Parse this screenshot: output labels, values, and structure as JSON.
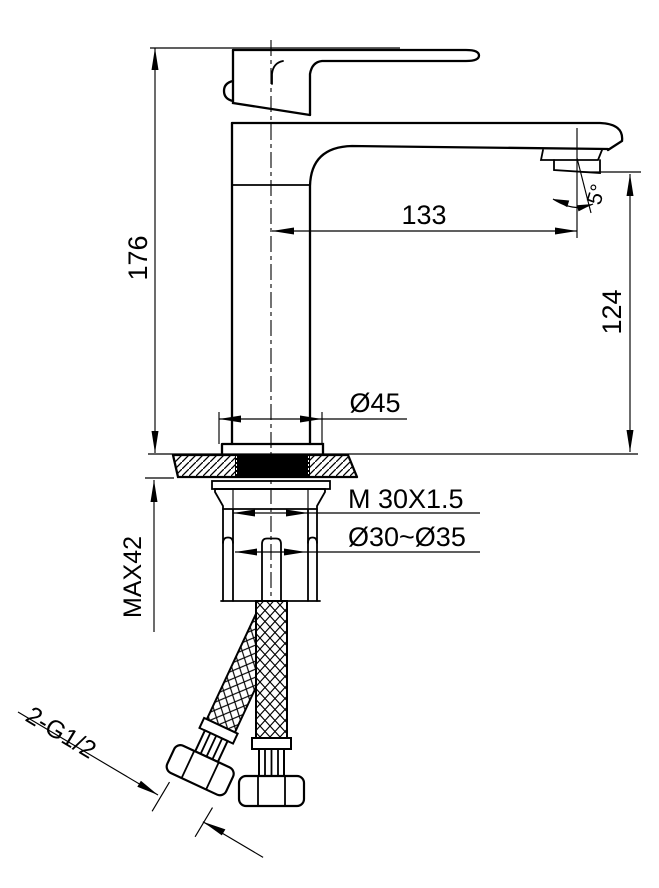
{
  "page": {
    "background": "#ffffff",
    "line_color": "#000000"
  },
  "drawing": {
    "dimensions": {
      "total_height": "176",
      "spout_reach": "133",
      "spout_height": "124",
      "base_diameter": "Ø45",
      "mounting_thread": "M 30X1.5",
      "mounting_hole_range": "Ø30~Ø35",
      "max_counter_thickness": "MAX42",
      "hose_thread": "2-G1/2",
      "spray_angle": "5°"
    }
  }
}
